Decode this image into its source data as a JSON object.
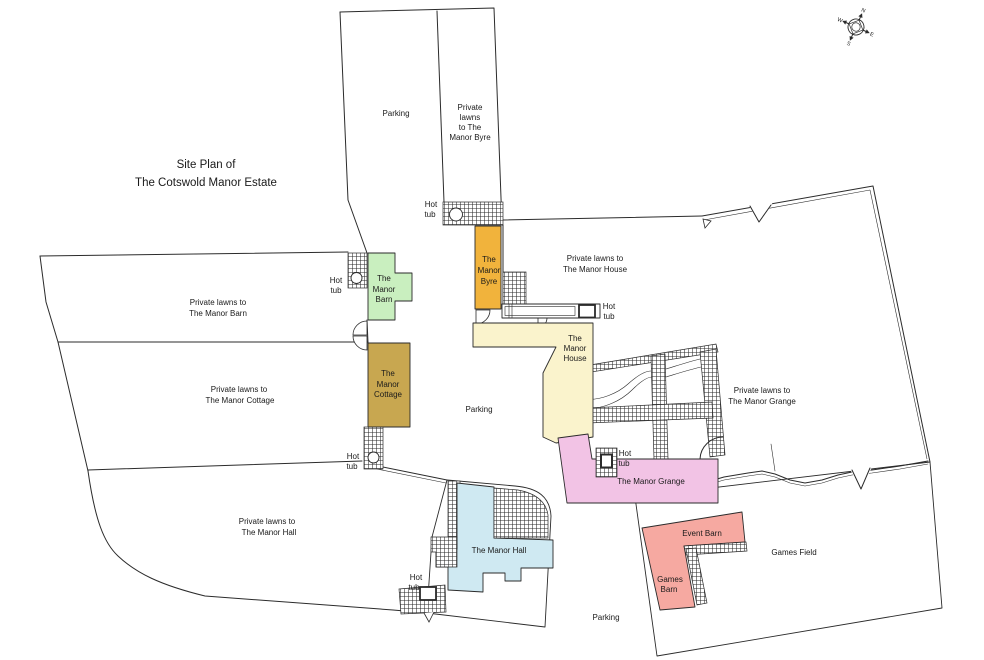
{
  "title": {
    "line1": "Site Plan of",
    "line2": "The Cotswold Manor Estate"
  },
  "compass": {
    "north": "N",
    "east": "E",
    "south": "S",
    "west": "W"
  },
  "labels": {
    "parking": "Parking",
    "games_field": "Games Field",
    "hot_tub": {
      "line1": "Hot",
      "line2": "tub"
    }
  },
  "lawns": {
    "byre_strip": {
      "line1": "Private",
      "line2": "lawns",
      "line3": "to The",
      "line4": "Manor Byre"
    },
    "barn": {
      "line1": "Private lawns to",
      "line2": "The Manor Barn"
    },
    "cottage": {
      "line1": "Private lawns to",
      "line2": "The Manor Cottage"
    },
    "hall": {
      "line1": "Private lawns to",
      "line2": "The Manor Hall"
    },
    "house": {
      "line1": "Private lawns to",
      "line2": "The Manor House"
    },
    "grange": {
      "line1": "Private lawns to",
      "line2": "The Manor Grange"
    }
  },
  "buildings": {
    "barn": {
      "line1": "The",
      "line2": "Manor",
      "line3": "Barn",
      "color": "#c9efbf"
    },
    "byre": {
      "line1": "The",
      "line2": "Manor",
      "line3": "Byre",
      "color": "#f1b33c"
    },
    "cottage": {
      "line1": "The",
      "line2": "Manor",
      "line3": "Cottage",
      "color": "#c8a750"
    },
    "house": {
      "line1": "The",
      "line2": "Manor",
      "line3": "House",
      "color": "#faf3cc"
    },
    "grange": {
      "label": "The Manor Grange",
      "color": "#f2c3e5"
    },
    "hall": {
      "label": "The Manor Hall",
      "color": "#cfe9f2"
    },
    "event_barn": {
      "label": "Event Barn",
      "color": "#f6a9a1"
    },
    "games_barn": {
      "line1": "Games",
      "line2": "Barn",
      "color": "#f6a9a1"
    }
  },
  "colors": {
    "outline": "#2b2b2b",
    "text": "#1a1a1a"
  }
}
